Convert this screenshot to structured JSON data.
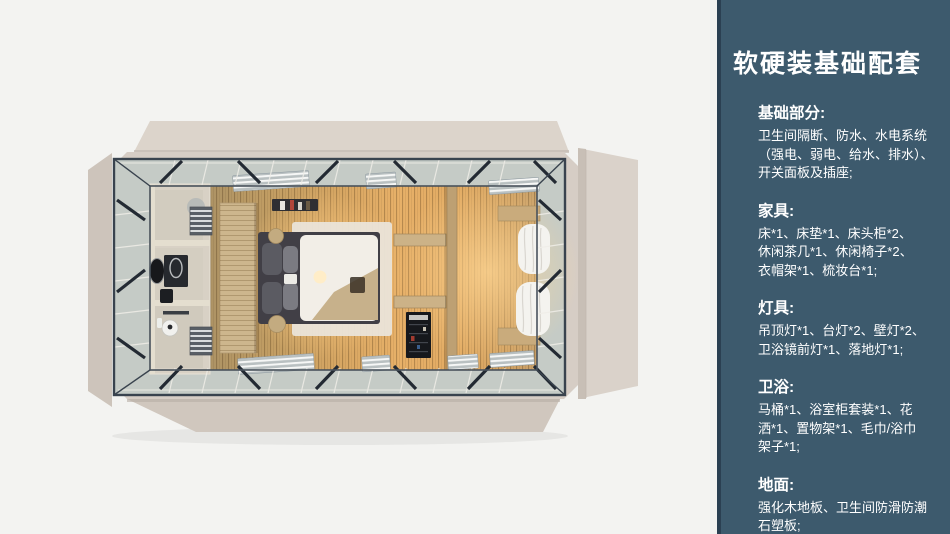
{
  "page": {
    "background": "#f3f3f1"
  },
  "sidebar": {
    "background": "#3d5a6d",
    "edge_stripe": "#2b4052",
    "text_color": "#ffffff",
    "title": "软硬装基础配套",
    "sections": [
      {
        "heading": "基础部分:",
        "lines": [
          "卫生间隔断、防水、水电系统",
          "（强电、弱电、给水、排水）、",
          "开关面板及插座;"
        ]
      },
      {
        "heading": "家具:",
        "lines": [
          "床*1、床垫*1、床头柜*2、",
          "休闲茶几*1、休闲椅子*2、",
          "衣帽架*1、梳妆台*1;"
        ]
      },
      {
        "heading": "灯具:",
        "lines": [
          "吊顶灯*1、台灯*2、壁灯*2、",
          "卫浴镜前灯*1、落地灯*1;"
        ]
      },
      {
        "heading": "卫浴:",
        "lines": [
          "马桶*1、浴室柜套装*1、花",
          "洒*1、置物架*1、毛巾/浴巾",
          "架子*1;"
        ]
      },
      {
        "heading": "地面:",
        "lines": [
          "强化木地板、卫生间防滑防潮",
          "石塑板;"
        ]
      }
    ]
  },
  "render_palette": {
    "roof_beige": "#d6cdc5",
    "flap_light": "#dcd4cb",
    "flap_dark": "#cdc4bb",
    "glass_band": "#c5cbc6",
    "steel_frame": "#39434e",
    "wood_floor": "#d8a763",
    "lamp_glow": "#ffe7b8",
    "bathroom_cream": "#d8d1c5",
    "bed_dark": "#413f46",
    "bed_white": "#f2eee7",
    "curtain_white": "#f4f3ef"
  }
}
